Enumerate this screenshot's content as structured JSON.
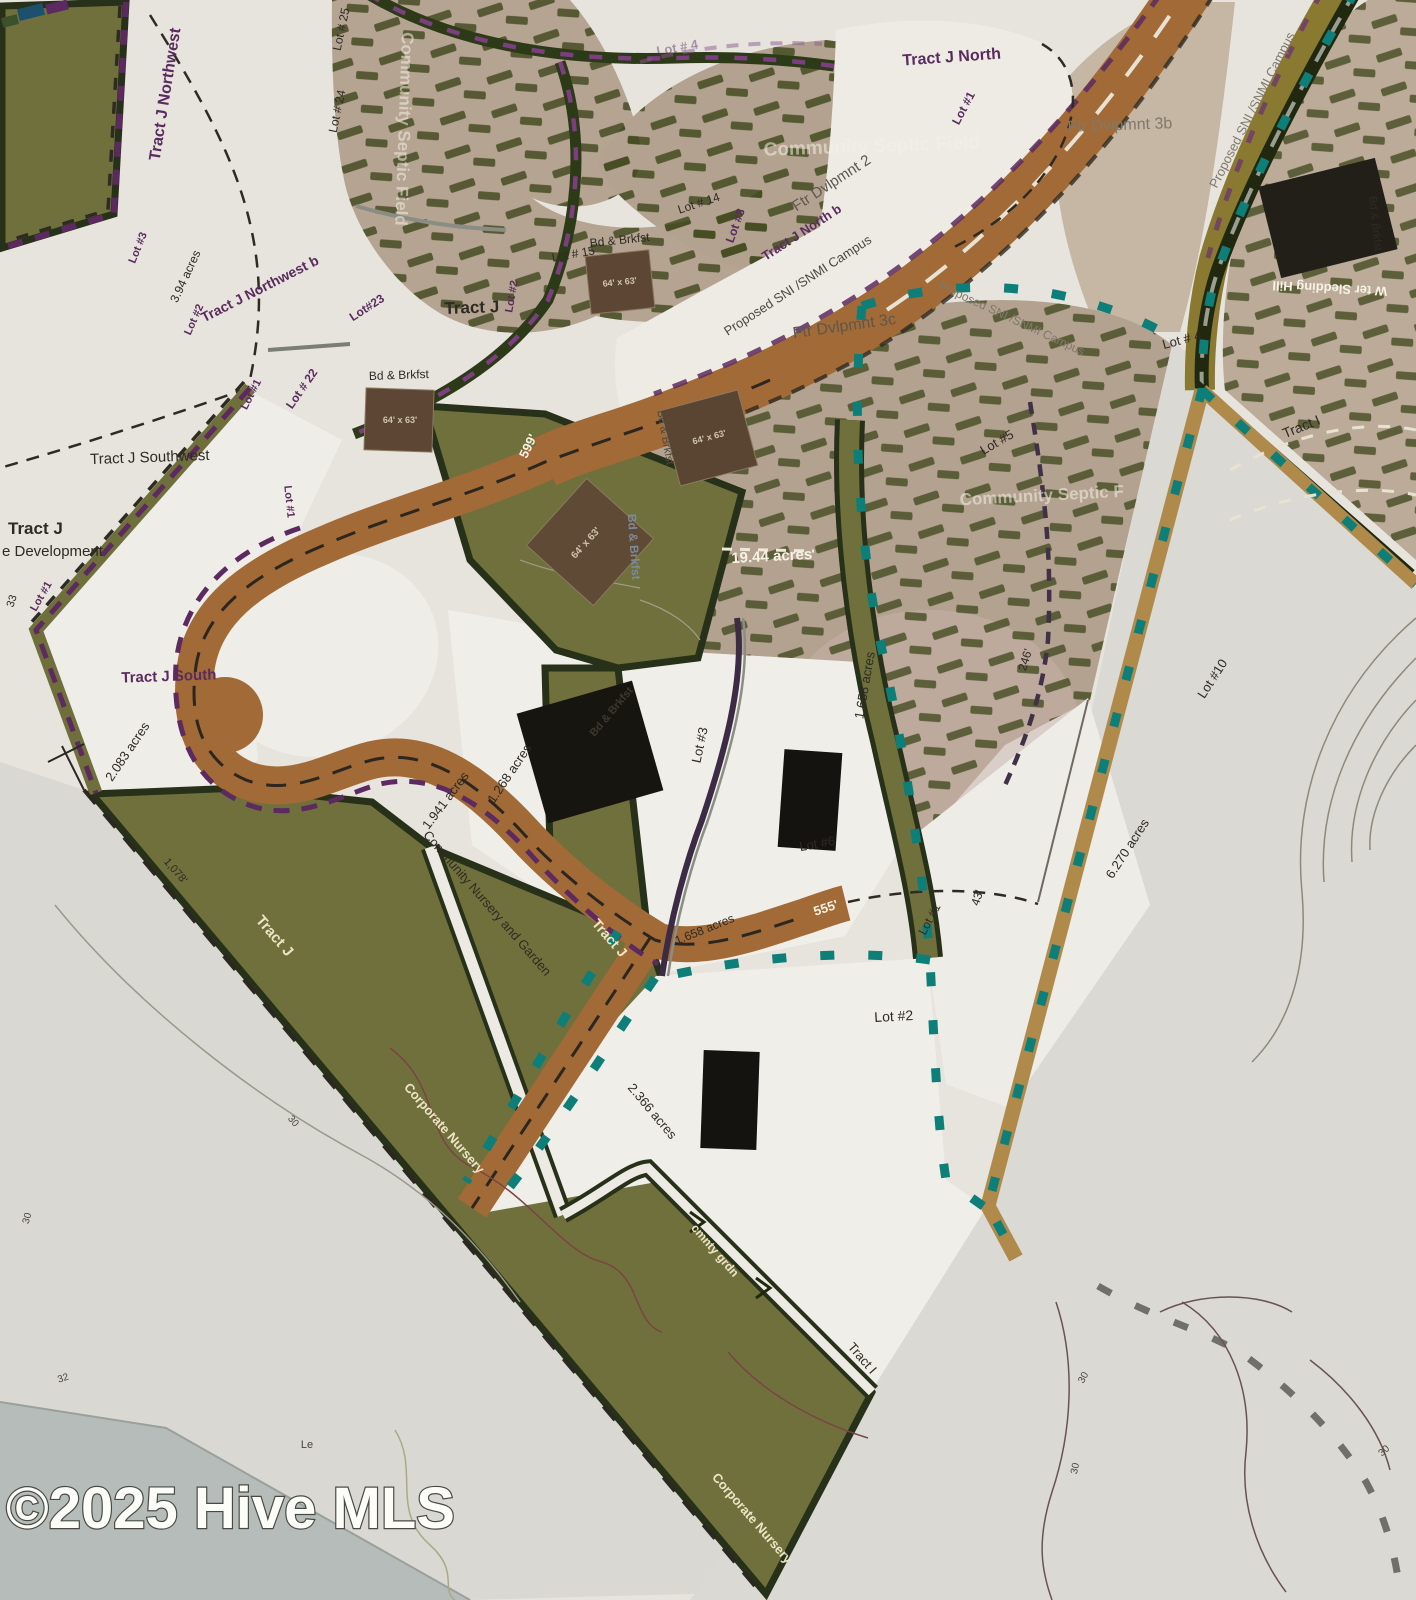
{
  "map_title": "Tract J land plat site plan",
  "watermark": {
    "text": "©2025 Hive MLS"
  },
  "colors": {
    "background": "#e7e4de",
    "parcel_olive": "#70703c",
    "parcel_border_green": "#273018",
    "road_brown": "#a26a36",
    "road_tan": "#b08a4a",
    "septic_taupe": "#b5a492",
    "boundary_teal": "#0e7e79",
    "boundary_purple": "#5c2a60",
    "water_gray_blue": "#b5bcba",
    "building_black": "#17150f",
    "building_brown": "#5d4734"
  },
  "labels": {
    "tract_j_northwest": "Tract J  Northwest",
    "tract_j_northwest_b": "Tract J  Northwest b",
    "tract_j_north": "Tract J North",
    "tract_j_north_b": "Tract J North b",
    "tract_j": "Tract J",
    "tract_j_southwest": "Tract J Southwest",
    "tract_j_south": "Tract J South",
    "tract_i": "Tract I",
    "development": "e Development",
    "lot_1": "Lot #1",
    "lot_2": "Lot #2",
    "lot_3": "Lot #3",
    "lot_4": "Lot # 4",
    "lot_5": "Lot #5",
    "lot_6": "Lot #6",
    "lot_10": "Lot #10",
    "lot_14": "Lot # 14",
    "lot_15": "Lot # 15",
    "lot_22": "Lot # 22",
    "lot_23": "Lot#23",
    "lot_24": "Lot # 24",
    "lot_25": "Lot # 25",
    "community_septic_field": "Community Septic Field",
    "community_septic_f": "Community Septic F",
    "ftr_dvlpmnt_2": "Ftr Dvlpmnt 2",
    "ftr_dvlpmnt_3b": "Ftr Dvlpmnt 3b",
    "ftr_dvlpmnt_3c": "Ftr Dvlpmnt 3c",
    "proposed_campus": "Proposed SNI /SNMI Campus",
    "bd_brkfst": "Bd & Brkfst",
    "dim_64x63": "64' x 63'",
    "acres_3_94": "3.94 acres",
    "acres_2_083": "2.083 acres",
    "acres_19_44": "19.44 acres",
    "acres_1_268": "1.268 acres",
    "acres_1_941": "1.941 acres",
    "acres_1_658": "1.658 acres",
    "acres_2_366": "2.366 acres",
    "acres_6_270": "6.270 acres",
    "len_599": "599'",
    "len_555": "555'",
    "len_1078": "1,078'",
    "len_246": "246'",
    "len_43": "43'",
    "len_33": "33",
    "community_nursery_and_garden": "Community Nursery and Garden",
    "corporate_nursery": "Corporate Nursery",
    "cmnty_grdn": "cmnty grdn",
    "water_sledding_hill": "W ter Sledding Hill",
    "le": "Le",
    "contour_30": "30",
    "contour_32": "32"
  }
}
